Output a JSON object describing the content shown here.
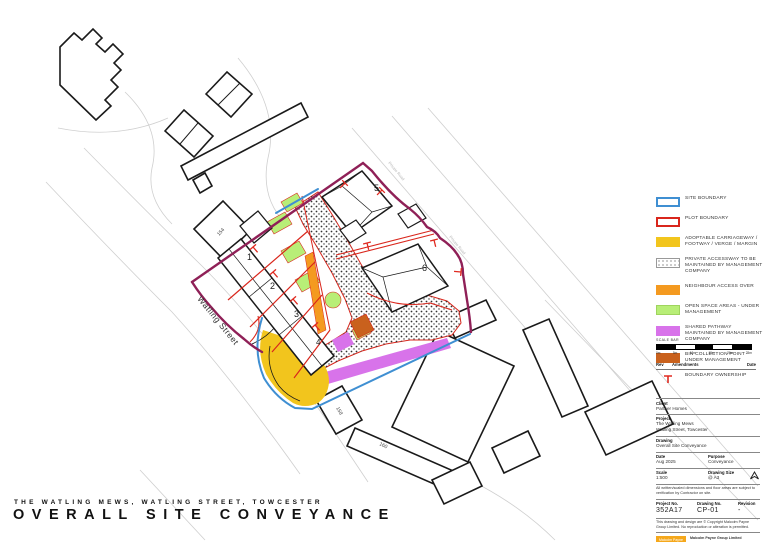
{
  "page": {
    "subtitle": "THE WATLING MEWS, WATLING STREET, TOWCESTER",
    "title": "OVERALL SITE CONVEYANCE"
  },
  "plan": {
    "street_label": "Watling Street",
    "road_label": "Private Road",
    "plots": {
      "p1": "1",
      "p2": "2",
      "p3": "3",
      "p4": "4",
      "p5": "5",
      "p6": "6"
    },
    "houses": {
      "h154": "154",
      "h158": "158",
      "h160": "160"
    }
  },
  "legend": {
    "items": [
      {
        "key": "site-boundary",
        "label": "SITE BOUNDARY"
      },
      {
        "key": "plot-boundary",
        "label": "PLOT BOUNDARY"
      },
      {
        "key": "adoptable-carriageway",
        "label": "ADOPTABLE CARRIAGEWAY / FOOTWAY / VERGE / MARGIN"
      },
      {
        "key": "private-accessway",
        "label": "PRIVATE ACCESSWAY TO BE MAINTAINED BY MANAGEMENT COMPANY"
      },
      {
        "key": "neighbour-access",
        "label": "NEIGHBOUR ACCESS OVER"
      },
      {
        "key": "open-space",
        "label": "OPEN SPACE AREAS - UNDER MANAGEMENT"
      },
      {
        "key": "shared-pathway",
        "label": "SHARED PATHWAY MAINTAINED BY MANAGEMENT COMPANY"
      },
      {
        "key": "bin-collection",
        "label": "BIN COLLECTION POINT - UNDER MANAGEMENT"
      },
      {
        "key": "boundary-ownership",
        "label": "BOUNDARY OWNERSHIP"
      }
    ],
    "colors": {
      "site_boundary": "#3f8fd2",
      "plot_boundary": "#d9261c",
      "adoptable": "#f2c51d",
      "neighbour_access": "#f49a20",
      "open_space": "#b8ee77",
      "shared_pathway": "#d873ea",
      "bin_collection": "#c9611d",
      "ownership_line": "#8f2057"
    }
  },
  "scale_bar": {
    "label": "SCALE BAR",
    "ticks": [
      "0m",
      "5m",
      "10m",
      "15m",
      "20m",
      "25m"
    ]
  },
  "revision_table": {
    "rev": "Rev",
    "amendments": "Amendments",
    "date": "Date"
  },
  "title_block": {
    "client_label": "Client",
    "client": "Partner Homes",
    "project_label": "Project",
    "project_line1": "The Watling Mews",
    "project_line2": "Watling Street, Towcester",
    "drawing_label": "Drawing",
    "drawing": "Overall Site Conveyance",
    "date_label": "Date",
    "date": "Aug 2025",
    "purpose_label": "Purpose",
    "purpose": "Conveyance",
    "scale_label": "Scale",
    "scale": "1:500",
    "size_label": "Drawing Size",
    "size": "@ A3",
    "note": "All written/scaled dimensions and floor areas are subject to verification by Contractor on site.",
    "project_no_label": "Project No.",
    "project_no": "352A17",
    "drawing_no_label": "Drawing No.",
    "drawing_no": "CP-01",
    "revision_label": "Revision",
    "revision": "-",
    "copyright": "This drawing and design are © Copyright Malcolm Payne Group Limited. No reproduction or alteration is permitted.",
    "logo_text": "Malcolm Payne Group Ltd",
    "company_name": "Malcolm Payne Group Limited",
    "company_address": "156 Holliday Street, Birmingham, B1 1TJ",
    "company_phone": "Telephone: +44(0)121 616 2100",
    "company_email": "info@malcolmpaynegroup.co.uk",
    "company_web": "www.malcolmpaynegroup.co.uk",
    "company_tagline": "Architects | Design | Conservation"
  }
}
